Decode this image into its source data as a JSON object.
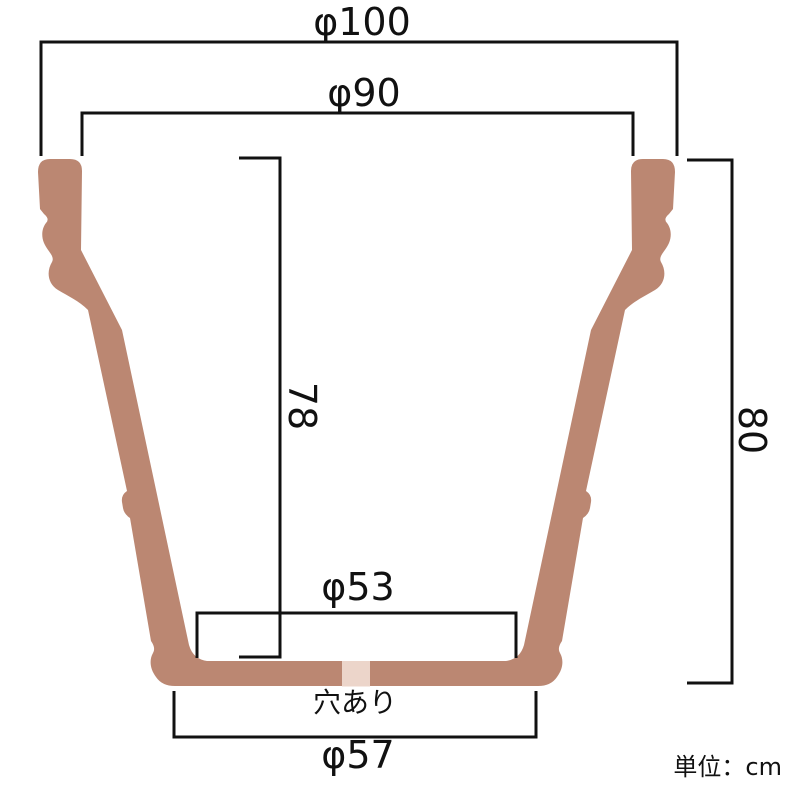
{
  "diagram": {
    "type": "pot-cross-section-dimension-diagram",
    "unit_note": "単位：cm",
    "labels": {
      "top_outer_diameter": "φ100",
      "top_inner_diameter": "φ90",
      "inner_depth": "78",
      "outer_height": "80",
      "inner_bottom_diameter": "φ53",
      "outer_bottom_diameter": "φ57",
      "drainage_hole": "穴あり"
    },
    "measurements_cm": {
      "top_outer_diameter": 100,
      "top_inner_diameter": 90,
      "inner_depth": 78,
      "outer_height": 80,
      "inner_bottom_diameter": 53,
      "outer_bottom_diameter": 57
    },
    "colors": {
      "pot_body": "#bb8772",
      "drainage_hole_fill": "#ecd5ca",
      "line": "#111111",
      "background": "#ffffff"
    }
  }
}
